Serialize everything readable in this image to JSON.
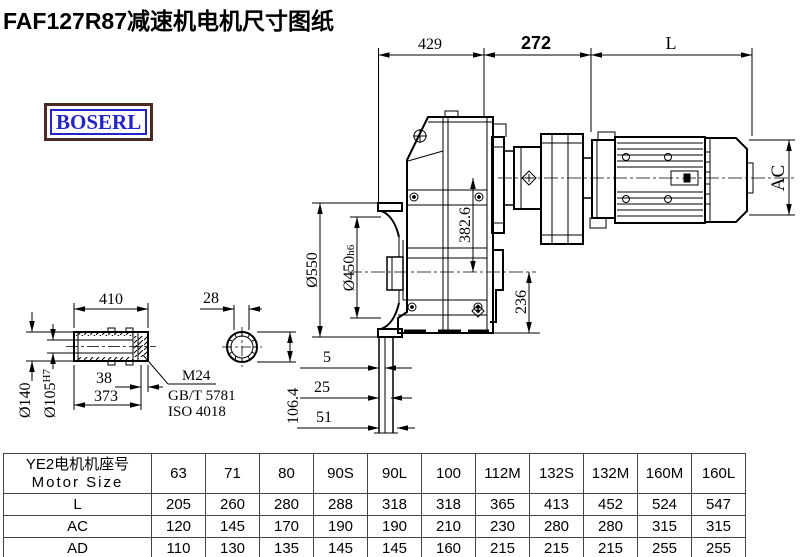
{
  "title": "FAF127R87减速机电机尺寸图纸",
  "logo": {
    "text": "BOSERL"
  },
  "colors": {
    "line": "#000000",
    "logo_text": "#2424c8",
    "logo_border": "#4a2a22",
    "background": "#ffffff"
  },
  "drawing": {
    "top_dims": {
      "d429": "429",
      "d272": "272",
      "dL": "L"
    },
    "flange_dims": {
      "phi550": "Ø550",
      "phi450": "Ø450",
      "phi450_tol": "h6"
    },
    "vertical_dims": {
      "d382": "382.6",
      "d236": "236",
      "dAC": "AC"
    },
    "mount_dims": {
      "d5": "5",
      "d25": "25",
      "d51": "51"
    },
    "shaft": {
      "d410": "410",
      "d38": "38",
      "d373": "373",
      "phi140": "Ø140",
      "phi105": "Ø105",
      "phi105_tol": "H7",
      "d28": "28",
      "d106": "106.4",
      "thread": "M24",
      "std_gb": "GB/T 5781",
      "std_iso": "ISO 4018"
    }
  },
  "table": {
    "header_cn": "YE2电机机座号",
    "header_en": "Motor Size",
    "columns": [
      "63",
      "71",
      "80",
      "90S",
      "90L",
      "100",
      "112M",
      "132S",
      "132M",
      "160M",
      "160L"
    ],
    "rows": [
      {
        "label": "L",
        "values": [
          "205",
          "260",
          "280",
          "288",
          "318",
          "318",
          "365",
          "413",
          "452",
          "524",
          "547"
        ]
      },
      {
        "label": "AC",
        "values": [
          "120",
          "145",
          "170",
          "190",
          "190",
          "210",
          "230",
          "280",
          "280",
          "315",
          "315"
        ]
      },
      {
        "label": "AD",
        "values": [
          "110",
          "130",
          "135",
          "145",
          "145",
          "160",
          "215",
          "215",
          "215",
          "255",
          "255"
        ]
      }
    ]
  }
}
